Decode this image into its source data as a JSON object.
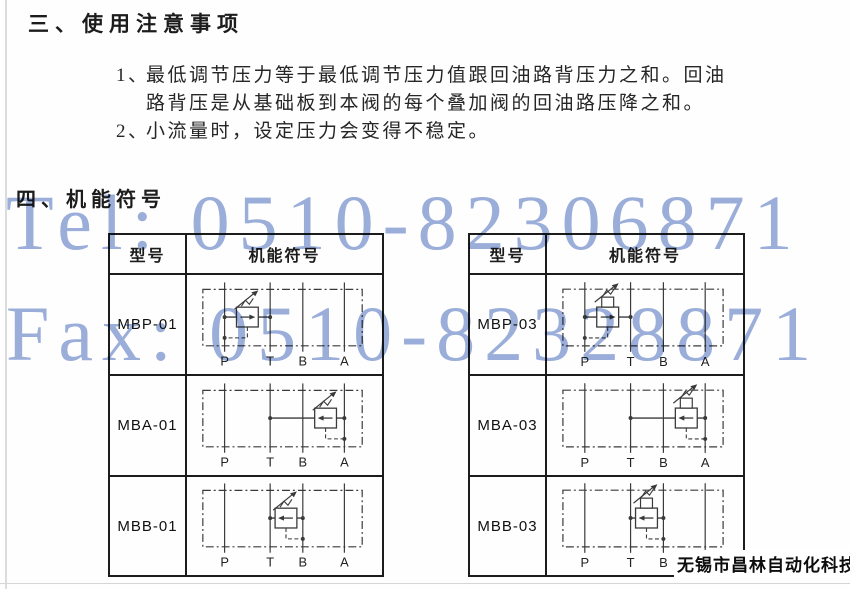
{
  "sections": {
    "usage_title": "三、使用注意事项",
    "symbols_title": "四、机能符号"
  },
  "notes": [
    {
      "num": "1、",
      "line1": "最低调节压力等于最低调节压力值跟回油路背压力之和。回油",
      "line2": "路背压是从基础板到本阀的每个叠加阀的回油路压降之和。"
    },
    {
      "num": "2、",
      "line1": "小流量时，设定压力会变得不稳定。"
    }
  ],
  "watermark": {
    "tel": "Tel: 0510-82306871",
    "fax": "Fax: 0510-82328871",
    "color": "#9bafda"
  },
  "tables": [
    {
      "headers": {
        "model": "型号",
        "symbol": "机能符号"
      },
      "rows": [
        {
          "model": "MBP-01",
          "valve": "P",
          "series": "01",
          "ports": [
            "P",
            "T",
            "B",
            "A"
          ]
        },
        {
          "model": "MBA-01",
          "valve": "A",
          "series": "01",
          "ports": [
            "P",
            "T",
            "B",
            "A"
          ]
        },
        {
          "model": "MBB-01",
          "valve": "B",
          "series": "01",
          "ports": [
            "P",
            "T",
            "B",
            "A"
          ]
        }
      ]
    },
    {
      "headers": {
        "model": "型号",
        "symbol": "机能符号"
      },
      "rows": [
        {
          "model": "MBP-03",
          "valve": "P",
          "series": "03",
          "ports": [
            "P",
            "T",
            "B",
            "A"
          ]
        },
        {
          "model": "MBA-03",
          "valve": "A",
          "series": "03",
          "ports": [
            "P",
            "T",
            "B",
            "A"
          ]
        },
        {
          "model": "MBB-03",
          "valve": "B",
          "series": "03",
          "ports": [
            "P",
            "T",
            "B",
            "A"
          ]
        }
      ]
    }
  ],
  "footer": {
    "company": "无锡市昌林自动化科技"
  }
}
